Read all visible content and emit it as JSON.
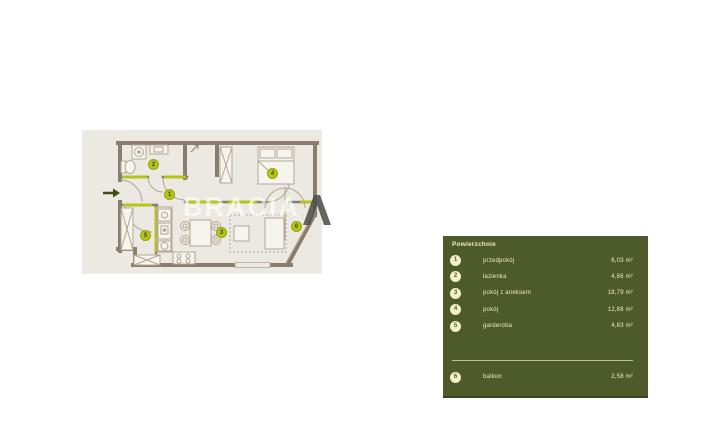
{
  "floorplan": {
    "watermark_text": "BRACIA",
    "room_badges": [
      {
        "num": "1"
      },
      {
        "num": "2"
      },
      {
        "num": "3"
      },
      {
        "num": "4"
      },
      {
        "num": "5"
      },
      {
        "num": "6"
      }
    ]
  },
  "legend": {
    "title": "Powierzchnie",
    "items": [
      {
        "num": "1",
        "label": "przedpokój",
        "area": "6,03 m²"
      },
      {
        "num": "2",
        "label": "łazienka",
        "area": "4,86 m²"
      },
      {
        "num": "3",
        "label": "pokój z aneksem",
        "area": "18,79 m²"
      },
      {
        "num": "4",
        "label": "pokój",
        "area": "12,88 m²"
      },
      {
        "num": "5",
        "label": "garderoba",
        "area": "4,83 m²"
      },
      {
        "num": "6",
        "label": "balkon",
        "area": "2,58 m²"
      }
    ]
  },
  "colors": {
    "accent_green": "#b5c417",
    "panel_olive": "#4d5b2a",
    "wall_brown": "#8a7d6e",
    "plan_beige": "#ece9e2",
    "cream": "#f3efcb"
  }
}
